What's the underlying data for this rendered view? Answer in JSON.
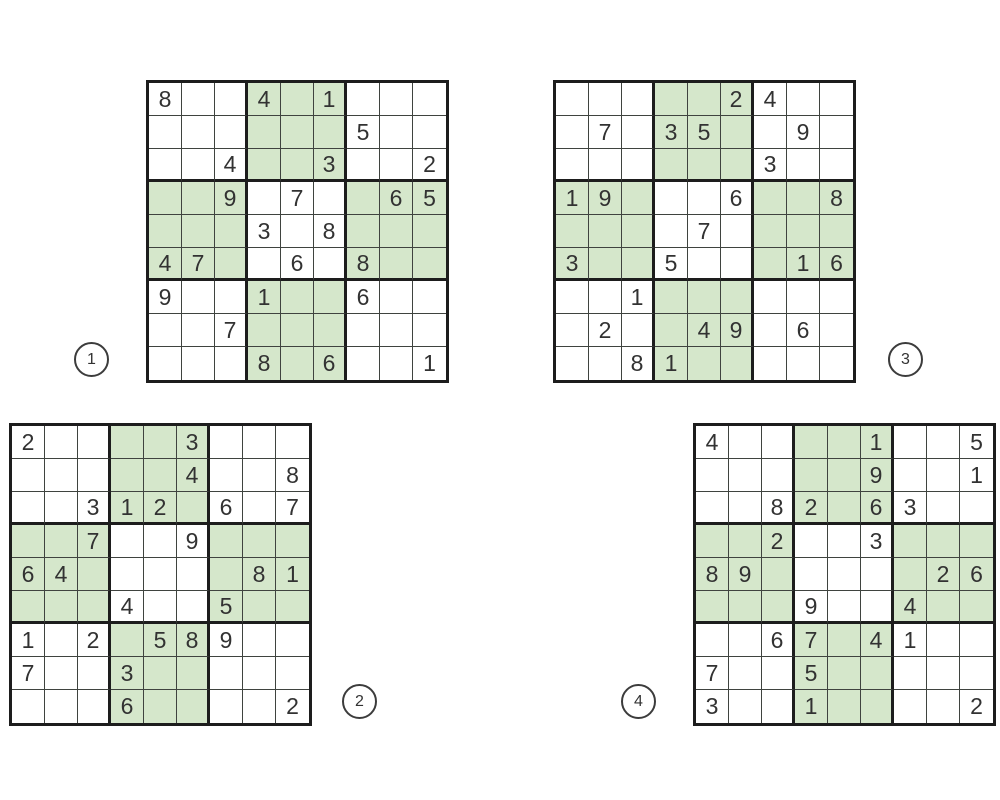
{
  "page": {
    "background": "#ffffff",
    "description": "Sheet of four sudoku puzzles"
  },
  "colors": {
    "cell_white": "#ffffff",
    "cell_green": "#d5e7cb",
    "grid_line": "#3f433f",
    "box_line": "#1d1d1d",
    "digit": "#323232",
    "badge_border": "#3c3c3c"
  },
  "green_boxes": [
    2,
    4,
    6,
    8
  ],
  "puzzles": [
    {
      "label": "1",
      "position": "top-left",
      "badge_position": "bottom-left-outside",
      "grid": [
        "8..4.1...",
        "......5..",
        "..4..3..2",
        "..9.7..65",
        "...3.8...",
        "47..6.8..",
        "9..1..6..",
        "..7......",
        "...8.6..1"
      ]
    },
    {
      "label": "2",
      "position": "bottom-left",
      "badge_position": "bottom-right-outside",
      "grid": [
        "2....3...",
        ".....4..8",
        "..312.6.7",
        "..7..9...",
        "64.....81",
        "...4..5..",
        "1.2.589..",
        "7..3.....",
        "...6....2"
      ]
    },
    {
      "label": "3",
      "position": "top-right",
      "badge_position": "bottom-right-outside",
      "grid": [
        ".....24..",
        ".7.35..9.",
        "......3..",
        "19...6..8",
        "....7....",
        "3..5...16",
        "..1......",
        ".2..49.6.",
        "..81....."
      ]
    },
    {
      "label": "4",
      "position": "bottom-right",
      "badge_position": "bottom-left-outside",
      "grid": [
        "4....1..5",
        ".....9..1",
        "..82.63..",
        "..2..3...",
        "89.....26",
        "...9..4..",
        "..67.41..",
        "7..5.....",
        "3..1....2"
      ]
    }
  ]
}
